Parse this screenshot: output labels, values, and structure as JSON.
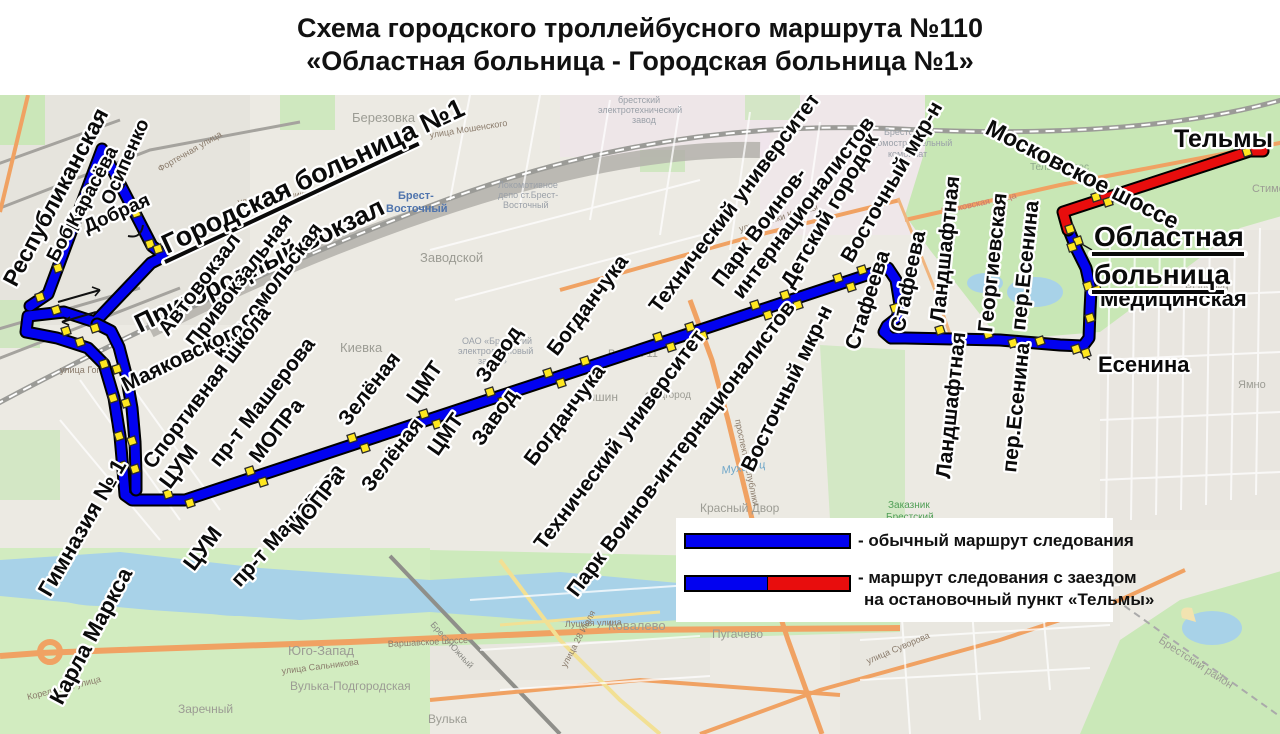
{
  "title": {
    "line1": "Схема городского троллейбусного маршрута №110",
    "line2": "«Областная больница - Городская больница №1»"
  },
  "legend": {
    "regular": "- обычный маршрут следования",
    "detour_line1": "- маршрут следования с заездом",
    "detour_line2": "на остановочный пункт «Тельмы»"
  },
  "colors": {
    "route_regular": "#0202f0",
    "route_detour": "#e80d0d",
    "route_casing": "#000000",
    "stop_marker_fill": "#ffe71f",
    "stop_marker_border": "#2b2b2b",
    "label_text": "#0a0a0a",
    "label_halo": "#ffffff",
    "water": "#a8d2e8",
    "park": "#cdeabc",
    "forest": "#c8e7b5"
  },
  "routes": [
    {
      "name": "main-route-blue",
      "color_key": "route_regular",
      "path": "M 30,306 L 48,294 L 102,149 L 152,246 L 160,252 L 163,257 L 151,263 L 95,322 L 64,312 L 28,316 L 26,332 L 57,338 L 88,348 L 104,364 L 114,398 L 120,436 L 123,470 L 125,495 L 132,500 L 185,500 L 888,268 L 896,280 L 900,305 L 897,318 L 887,326 L 884,332 L 891,338 L 905,338 L 1000,340 L 1060,345 L 1083,346 L 1089,338 L 1090,310 L 1091,290 L 1086,268 L 1077,250 L 1068,228"
    },
    {
      "name": "station-parallel-blue",
      "color_key": "route_regular",
      "path": "M 97,324 L 111,331 L 119,347 L 126,374 L 132,408 L 135,442 L 136,473 L 136,490"
    },
    {
      "name": "telmy-detour-red",
      "color_key": "route_detour",
      "path": "M 1068,230 L 1063,212 L 1250,151 L 1263,151"
    }
  ],
  "stop_markers": [
    [
      74,
      222
    ],
    [
      91,
      187
    ],
    [
      104,
      167
    ],
    [
      136,
      213
    ],
    [
      150,
      244
    ],
    [
      158,
      249
    ],
    [
      58,
      268
    ],
    [
      40,
      297
    ],
    [
      56,
      310
    ],
    [
      66,
      331
    ],
    [
      80,
      342
    ],
    [
      95,
      328
    ],
    [
      104,
      364
    ],
    [
      117,
      369
    ],
    [
      113,
      398
    ],
    [
      126,
      403
    ],
    [
      119,
      436
    ],
    [
      132,
      441
    ],
    [
      122,
      466
    ],
    [
      135,
      469
    ],
    [
      168,
      494
    ],
    [
      190,
      503
    ],
    [
      250,
      471
    ],
    [
      263,
      482
    ],
    [
      352,
      438
    ],
    [
      365,
      448
    ],
    [
      424,
      414
    ],
    [
      437,
      424
    ],
    [
      490,
      392
    ],
    [
      503,
      401
    ],
    [
      548,
      373
    ],
    [
      561,
      383
    ],
    [
      585,
      361
    ],
    [
      598,
      371
    ],
    [
      658,
      337
    ],
    [
      671,
      347
    ],
    [
      690,
      327
    ],
    [
      703,
      336
    ],
    [
      755,
      305
    ],
    [
      768,
      315
    ],
    [
      785,
      295
    ],
    [
      798,
      305
    ],
    [
      838,
      278
    ],
    [
      851,
      287
    ],
    [
      862,
      270
    ],
    [
      895,
      308
    ],
    [
      940,
      330
    ],
    [
      988,
      334
    ],
    [
      1013,
      343
    ],
    [
      1040,
      341
    ],
    [
      1076,
      349
    ],
    [
      1086,
      353
    ],
    [
      1090,
      318
    ],
    [
      1088,
      286
    ],
    [
      1097,
      290
    ],
    [
      1078,
      241
    ],
    [
      1070,
      229
    ],
    [
      1072,
      247
    ],
    [
      1096,
      197
    ],
    [
      1108,
      202
    ],
    [
      1247,
      152
    ]
  ],
  "stop_labels": [
    {
      "t": "Республиканская",
      "x": 16,
      "y": 288,
      "r": -62,
      "s": 23
    },
    {
      "t": "Боброва",
      "x": 57,
      "y": 263,
      "r": -62,
      "s": 19
    },
    {
      "t": "Карасёва",
      "x": 77,
      "y": 228,
      "r": -62,
      "s": 19
    },
    {
      "t": "Осипенко",
      "x": 112,
      "y": 206,
      "r": -66,
      "s": 19
    },
    {
      "t": "Добрая",
      "x": 87,
      "y": 233,
      "r": -24,
      "s": 19
    },
    {
      "t": "Городская больница №1",
      "x": 167,
      "y": 254,
      "r": -25,
      "s": 27,
      "ulw": 280
    },
    {
      "t": "Пригородный вокзал",
      "x": 140,
      "y": 333,
      "r": -26,
      "s": 26
    },
    {
      "t": "Автовокзал",
      "x": 168,
      "y": 337,
      "r": -53,
      "s": 21
    },
    {
      "t": "Привокзальная",
      "x": 196,
      "y": 349,
      "r": -53,
      "s": 21
    },
    {
      "t": "Комсомольская",
      "x": 224,
      "y": 361,
      "r": -53,
      "s": 21
    },
    {
      "t": "Маяковского",
      "x": 126,
      "y": 392,
      "r": -26,
      "s": 21
    },
    {
      "t": "Спортивная школа",
      "x": 153,
      "y": 470,
      "r": -53,
      "s": 21
    },
    {
      "t": "Гимназия № 1",
      "x": 50,
      "y": 598,
      "r": -60,
      "s": 22
    },
    {
      "t": "Карла Маркса",
      "x": 62,
      "y": 706,
      "r": -62,
      "s": 22
    },
    {
      "t": "ЦУМ",
      "x": 170,
      "y": 490,
      "r": -53,
      "s": 22
    },
    {
      "t": "ЦУМ",
      "x": 194,
      "y": 572,
      "r": -53,
      "s": 22
    },
    {
      "t": "пр-т Машерова",
      "x": 219,
      "y": 468,
      "r": -52,
      "s": 21
    },
    {
      "t": "пр-т Машерова",
      "x": 240,
      "y": 588,
      "r": -48,
      "s": 21
    },
    {
      "t": "МОПРа",
      "x": 259,
      "y": 464,
      "r": -52,
      "s": 21
    },
    {
      "t": "МОПРа",
      "x": 299,
      "y": 536,
      "r": -52,
      "s": 21
    },
    {
      "t": "Зелёная",
      "x": 348,
      "y": 427,
      "r": -52,
      "s": 21
    },
    {
      "t": "Зелёная",
      "x": 371,
      "y": 493,
      "r": -52,
      "s": 21
    },
    {
      "t": "ЦМТ",
      "x": 417,
      "y": 405,
      "r": -55,
      "s": 21
    },
    {
      "t": "ЦМТ",
      "x": 438,
      "y": 457,
      "r": -55,
      "s": 21
    },
    {
      "t": "Завод",
      "x": 486,
      "y": 384,
      "r": -55,
      "s": 21
    },
    {
      "t": "Завод",
      "x": 482,
      "y": 447,
      "r": -55,
      "s": 21
    },
    {
      "t": "Богданчука",
      "x": 557,
      "y": 357,
      "r": -53,
      "s": 21
    },
    {
      "t": "Богданчука",
      "x": 534,
      "y": 467,
      "r": -53,
      "s": 21
    },
    {
      "t": "Технический университет",
      "x": 659,
      "y": 314,
      "r": -53,
      "s": 21
    },
    {
      "t": "Технический университет",
      "x": 544,
      "y": 551,
      "r": -53,
      "s": 21
    },
    {
      "t": "Парк Воинов-",
      "x": 722,
      "y": 288,
      "r": -53,
      "s": 21
    },
    {
      "t": "интернационалистов",
      "x": 742,
      "y": 300,
      "r": -53,
      "s": 21
    },
    {
      "t": "Парк Воинов-интернационалистов",
      "x": 577,
      "y": 598,
      "r": -53,
      "s": 21
    },
    {
      "t": "Детский городок",
      "x": 792,
      "y": 289,
      "r": -60,
      "s": 21
    },
    {
      "t": "Восточный мкр-н",
      "x": 852,
      "y": 264,
      "r": -60,
      "s": 21
    },
    {
      "t": "Восточный мкр-н",
      "x": 753,
      "y": 473,
      "r": -64,
      "s": 21
    },
    {
      "t": "Стафеева",
      "x": 858,
      "y": 351,
      "r": -72,
      "s": 21
    },
    {
      "t": "Стафеева",
      "x": 904,
      "y": 333,
      "r": -78,
      "s": 21
    },
    {
      "t": "Ландшафтная",
      "x": 944,
      "y": 323,
      "r": -84,
      "s": 21
    },
    {
      "t": "Ландшафтная",
      "x": 950,
      "y": 479,
      "r": -84,
      "s": 21
    },
    {
      "t": "Георгиевская",
      "x": 992,
      "y": 333,
      "r": -84,
      "s": 21
    },
    {
      "t": "пер.Есенина",
      "x": 1025,
      "y": 331,
      "r": -84,
      "s": 21
    },
    {
      "t": "пер.Есенина",
      "x": 1016,
      "y": 473,
      "r": -84,
      "s": 21
    },
    {
      "t": "Есенина",
      "x": 1098,
      "y": 372,
      "r": 0,
      "s": 22
    },
    {
      "t": "Медицинская",
      "x": 1100,
      "y": 306,
      "r": 0,
      "s": 22
    },
    {
      "t": "Областная",
      "x": 1094,
      "y": 246,
      "r": 0,
      "s": 28,
      "ulw": 152
    },
    {
      "t": "больница",
      "x": 1094,
      "y": 284,
      "r": 0,
      "s": 28,
      "ulw": 132
    },
    {
      "t": "Тельмы",
      "x": 1174,
      "y": 147,
      "r": 0,
      "s": 25
    },
    {
      "t": "Московское шоссе",
      "x": 984,
      "y": 133,
      "r": 27,
      "s": 23
    }
  ],
  "map_labels": [
    {
      "t": "Березовка",
      "x": 352,
      "y": 122,
      "s": 13,
      "c": "#9c9c94"
    },
    {
      "t": "Брест-",
      "x": 398,
      "y": 199,
      "s": 11,
      "c": "#4f74ad",
      "b": 1
    },
    {
      "t": "Восточный",
      "x": 386,
      "y": 212,
      "s": 11,
      "c": "#4f74ad",
      "b": 1
    },
    {
      "t": "Заводской",
      "x": 420,
      "y": 262,
      "s": 13,
      "c": "#9c9c94"
    },
    {
      "t": "Киевка",
      "x": 340,
      "y": 352,
      "s": 13,
      "c": "#9c9c94"
    },
    {
      "t": "Восток-11",
      "x": 608,
      "y": 357,
      "s": 11,
      "c": "#9c9c94"
    },
    {
      "t": "Тришин",
      "x": 575,
      "y": 401,
      "s": 12,
      "c": "#9c9c94"
    },
    {
      "t": "студгород",
      "x": 645,
      "y": 398,
      "s": 10,
      "c": "#9c9c94"
    },
    {
      "t": "Ковалево",
      "x": 608,
      "y": 630,
      "s": 13,
      "c": "#9c9c94"
    },
    {
      "t": "Пугачево",
      "x": 712,
      "y": 638,
      "s": 12,
      "c": "#9c9c94"
    },
    {
      "t": "Юго-Запад",
      "x": 288,
      "y": 655,
      "s": 13,
      "c": "#9c9c94"
    },
    {
      "t": "Заречный",
      "x": 178,
      "y": 713,
      "s": 12,
      "c": "#9c9c94"
    },
    {
      "t": "Вулька-Подгородская",
      "x": 290,
      "y": 690,
      "s": 12,
      "c": "#9c9c94"
    },
    {
      "t": "Вулька",
      "x": 428,
      "y": 723,
      "s": 12,
      "c": "#9c9c94"
    },
    {
      "t": "Красный Двор",
      "x": 700,
      "y": 512,
      "s": 12,
      "c": "#9c9c94"
    },
    {
      "t": "Ямно",
      "x": 1238,
      "y": 388,
      "s": 11,
      "c": "#9c9c94"
    },
    {
      "t": "Вычулки",
      "x": 1185,
      "y": 292,
      "s": 11,
      "c": "#9c9c94"
    },
    {
      "t": "Стимово",
      "x": 1252,
      "y": 192,
      "s": 11,
      "c": "#9c9c94"
    },
    {
      "t": "Тельмин лес",
      "x": 1030,
      "y": 170,
      "s": 10,
      "c": "#8fa98c"
    },
    {
      "t": "Брестский район",
      "x": 1158,
      "y": 642,
      "s": 11,
      "c": "#9c9c94",
      "r": 33
    },
    {
      "t": "Мухавец",
      "x": 722,
      "y": 474,
      "s": 11,
      "c": "#6fa7c9",
      "i": 1,
      "r": -8
    },
    {
      "t": "улица Мошенского",
      "x": 430,
      "y": 138,
      "s": 9,
      "c": "#8a7b6b",
      "r": -9
    },
    {
      "t": "улица Янки Купалы",
      "x": 740,
      "y": 232,
      "s": 9,
      "c": "#8a7b6b",
      "r": -16
    },
    {
      "t": "улица Скрипникова",
      "x": 238,
      "y": 205,
      "s": 9,
      "c": "#8a7b6b",
      "r": -7
    },
    {
      "t": "Фортечная улица",
      "x": 160,
      "y": 172,
      "s": 9,
      "c": "#8a7b6b",
      "r": -30
    },
    {
      "t": "улица Гоголя",
      "x": 60,
      "y": 373,
      "s": 9,
      "c": "#8a7b6b"
    },
    {
      "t": "Варшавское шоссе",
      "x": 388,
      "y": 647,
      "s": 9,
      "c": "#8a7b6b",
      "r": -3
    },
    {
      "t": "улица Суворова",
      "x": 868,
      "y": 664,
      "s": 9,
      "c": "#8a7b6b",
      "r": -23
    },
    {
      "t": "улица 28 Июля",
      "x": 566,
      "y": 668,
      "s": 9,
      "c": "#8a7b6b",
      "r": -62
    },
    {
      "t": "проспект Республики",
      "x": 735,
      "y": 420,
      "s": 9,
      "c": "#8a7b6b",
      "r": 78
    },
    {
      "t": "Луцкая улица",
      "x": 565,
      "y": 627,
      "s": 9,
      "c": "#8a7b6b",
      "r": -2
    },
    {
      "t": "улица Сальникова",
      "x": 282,
      "y": 674,
      "s": 9,
      "c": "#8a7b6b",
      "r": -7
    },
    {
      "t": "Московская улица",
      "x": 942,
      "y": 214,
      "s": 9,
      "c": "#c97a6e",
      "r": -12
    },
    {
      "t": "Корельская улица",
      "x": 28,
      "y": 700,
      "s": 9,
      "c": "#8a7b6b",
      "r": -14
    },
    {
      "t": "Брест-Южный",
      "x": 430,
      "y": 625,
      "s": 9,
      "c": "#8a8a84",
      "r": 48
    },
    {
      "t": "брестский",
      "x": 618,
      "y": 103,
      "s": 9,
      "c": "#9aa0a8"
    },
    {
      "t": "электротехнический",
      "x": 598,
      "y": 113,
      "s": 9,
      "c": "#9aa0a8"
    },
    {
      "t": "завод",
      "x": 632,
      "y": 123,
      "s": 9,
      "c": "#9aa0a8"
    },
    {
      "t": "Локомотивное",
      "x": 498,
      "y": 188,
      "s": 9,
      "c": "#9aa0a8"
    },
    {
      "t": "депо ст.Брест-",
      "x": 498,
      "y": 198,
      "s": 9,
      "c": "#9aa0a8"
    },
    {
      "t": "Восточный",
      "x": 503,
      "y": 208,
      "s": 9,
      "c": "#9aa0a8"
    },
    {
      "t": "ОАО «Брестский",
      "x": 462,
      "y": 344,
      "s": 9,
      "c": "#9aa0a8"
    },
    {
      "t": "электроламповый",
      "x": 458,
      "y": 354,
      "s": 9,
      "c": "#9aa0a8"
    },
    {
      "t": "завод»",
      "x": 478,
      "y": 364,
      "s": 9,
      "c": "#9aa0a8"
    },
    {
      "t": "Брестский",
      "x": 884,
      "y": 135,
      "s": 9,
      "c": "#9aa0a8"
    },
    {
      "t": "домостроительный",
      "x": 872,
      "y": 146,
      "s": 9,
      "c": "#9aa0a8"
    },
    {
      "t": "комбинат",
      "x": 888,
      "y": 157,
      "s": 9,
      "c": "#9aa0a8"
    },
    {
      "t": "Заказник",
      "x": 888,
      "y": 508,
      "s": 10,
      "c": "#4f9e55"
    },
    {
      "t": "Брестский",
      "x": 886,
      "y": 520,
      "s": 10,
      "c": "#4f9e55"
    },
    {
      "t": "450",
      "x": 951,
      "y": 563,
      "s": 9,
      "c": "#6b6b6b"
    }
  ]
}
